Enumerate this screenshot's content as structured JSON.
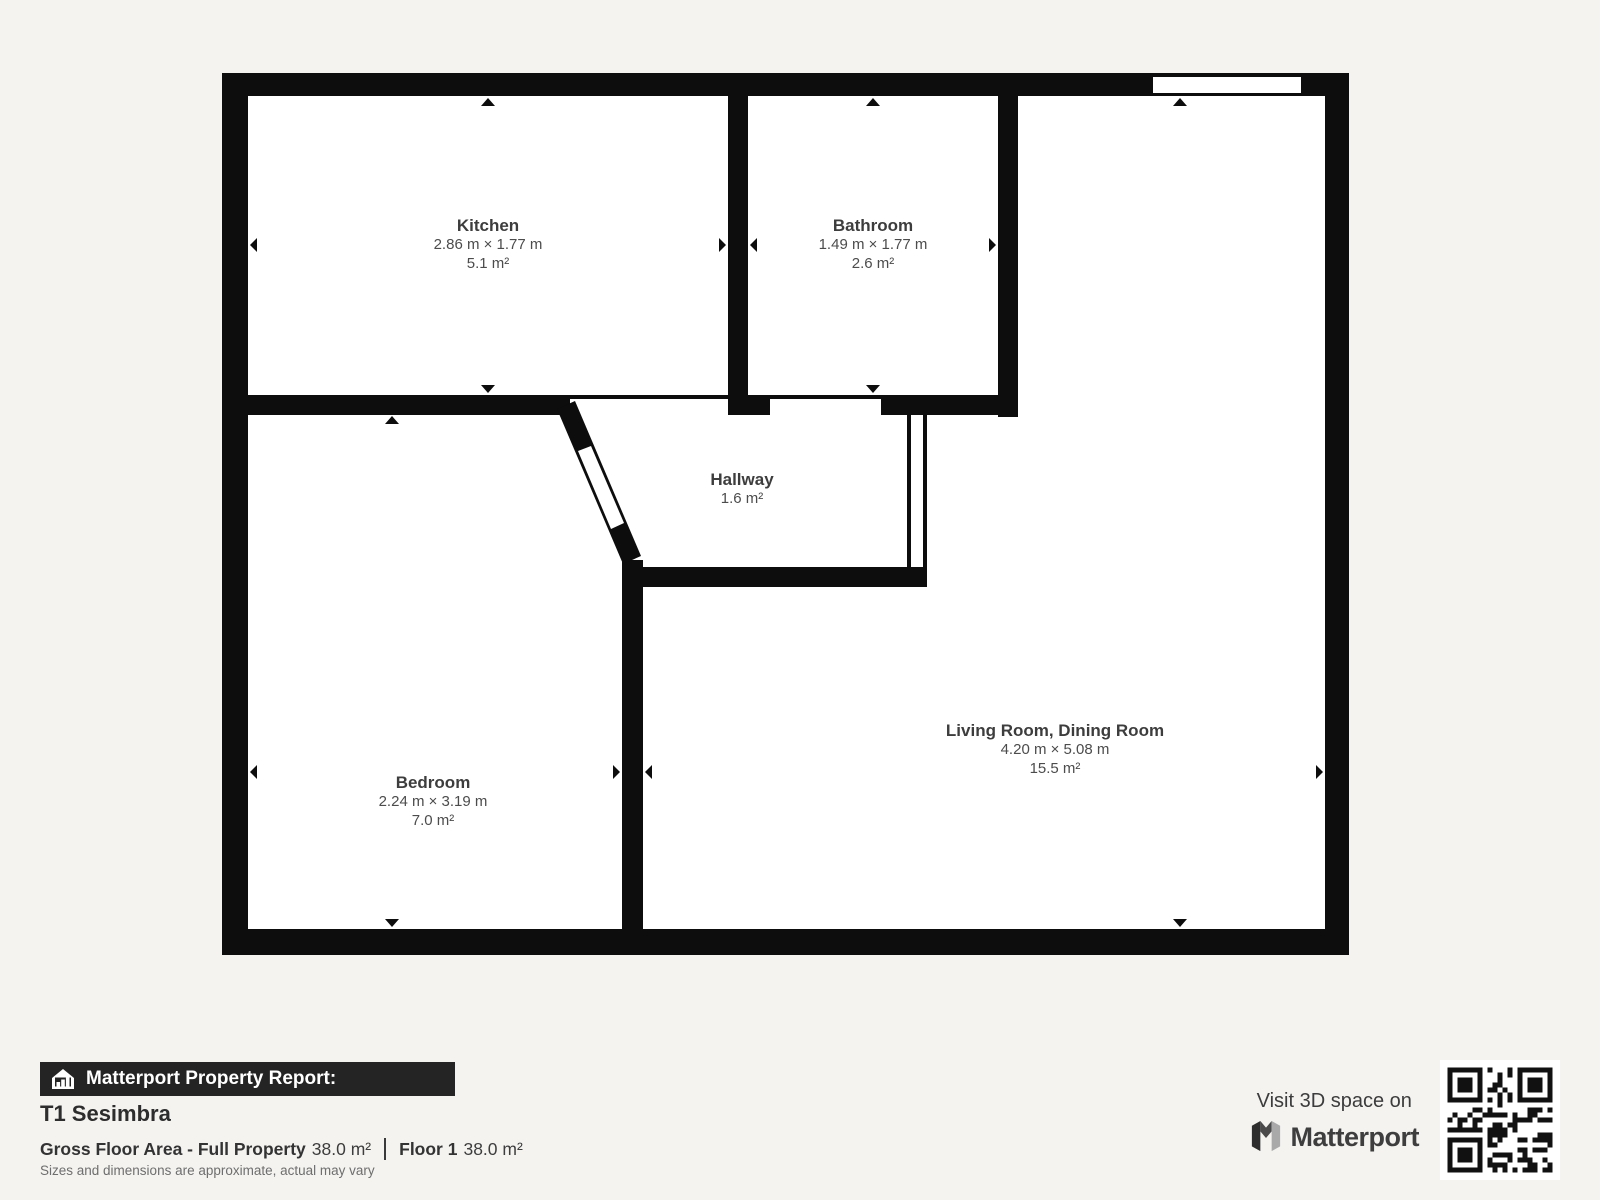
{
  "rooms": [
    {
      "id": "kitchen",
      "name": "Kitchen",
      "dimensions": "2.86 m × 1.77 m",
      "area": "5.1 m²"
    },
    {
      "id": "bathroom",
      "name": "Bathroom",
      "dimensions": "1.49 m × 1.77 m",
      "area": "2.6 m²"
    },
    {
      "id": "hallway",
      "name": "Hallway",
      "dimensions": "",
      "area": "1.6 m²"
    },
    {
      "id": "bedroom",
      "name": "Bedroom",
      "dimensions": "2.24 m × 3.19 m",
      "area": "7.0 m²"
    },
    {
      "id": "living",
      "name": "Living Room, Dining Room",
      "dimensions": "4.20 m × 5.08 m",
      "area": "15.5 m²"
    }
  ],
  "report": {
    "banner_label": "Matterport Property Report:",
    "property_name": "T1 Sesimbra",
    "gross_floor_area_label": "Gross Floor Area - Full Property",
    "gross_floor_area_value": "38.0 m²",
    "floor_label": "Floor 1",
    "floor_value": "38.0 m²",
    "disclaimer": "Sizes and dimensions are approximate, actual may vary"
  },
  "branding": {
    "visit_text": "Visit 3D space on",
    "brand_name": "Matterport"
  },
  "colors": {
    "background": "#f4f3f0",
    "wall": "#0d0d0d",
    "floor": "#ffffff",
    "label_title": "#3d3d3d",
    "label_text": "#4c4c4c",
    "banner_bg": "#242424",
    "banner_text": "#ffffff"
  }
}
